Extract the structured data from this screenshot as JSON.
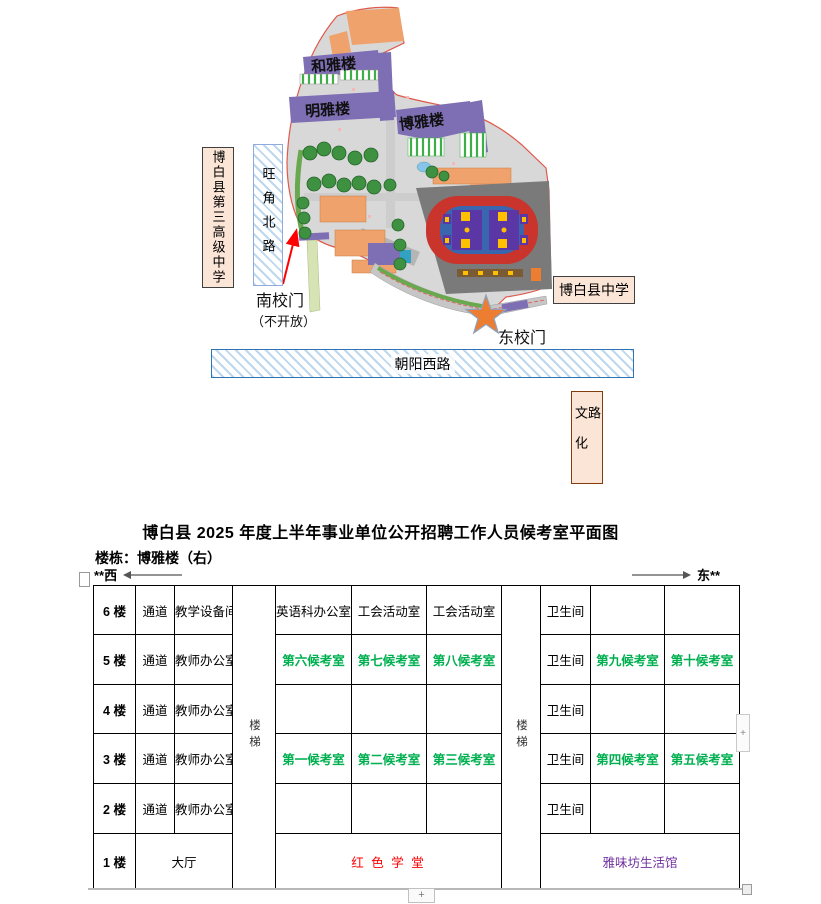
{
  "map": {
    "building_labels": {
      "heyalou": "和雅楼",
      "mingyalou": "明雅楼",
      "boyalou": "博雅楼"
    },
    "left_school": "博白县第三高级中学",
    "west_road": "旺角北路",
    "south_gate": "南校门",
    "south_gate_note": "（不开放）",
    "right_school": "博白县中学",
    "east_gate": "东校门",
    "south_road": "朝阳西路",
    "east_road": "文化路"
  },
  "doc": {
    "title": "博白县 2025 年度上半年事业单位公开招聘工作人员候考室平面图",
    "building_line": "楼栋：博雅楼（右）",
    "west_label": "**西",
    "east_label": "东**"
  },
  "table": {
    "stairs": "楼梯",
    "rows": [
      {
        "floor": "6 楼",
        "corridor": "通道",
        "office": "教学设备间",
        "room1": "英语科办公室",
        "room2": "工会活动室",
        "room3": "工会活动室",
        "wc": "卫生间",
        "room4": "",
        "room5": ""
      },
      {
        "floor": "5 楼",
        "corridor": "通道",
        "office": "教师办公室",
        "room1": "第六候考室",
        "room2": "第七候考室",
        "room3": "第八候考室",
        "wc": "卫生间",
        "room4": "第九候考室",
        "room5": "第十候考室"
      },
      {
        "floor": "4 楼",
        "corridor": "通道",
        "office": "教师办公室",
        "room1": "",
        "room2": "",
        "room3": "",
        "wc": "卫生间",
        "room4": "",
        "room5": ""
      },
      {
        "floor": "3 楼",
        "corridor": "通道",
        "office": "教师办公室",
        "room1": "第一候考室",
        "room2": "第二候考室",
        "room3": "第三候考室",
        "wc": "卫生间",
        "room4": "第四候考室",
        "room5": "第五候考室"
      },
      {
        "floor": "2 楼",
        "corridor": "通道",
        "office": "教师办公室",
        "room1": "",
        "room2": "",
        "room3": "",
        "wc": "卫生间",
        "room4": "",
        "room5": ""
      }
    ],
    "floor1": {
      "floor": "1 楼",
      "hall": "大厅",
      "center": "红 色 学 堂",
      "right": "雅味坊生活馆"
    },
    "colors": {
      "waiting_room": "#00B050",
      "red_hall": "#FF0000",
      "purple_hall": "#7030A0"
    }
  },
  "artifacts": {
    "plus": "+"
  }
}
